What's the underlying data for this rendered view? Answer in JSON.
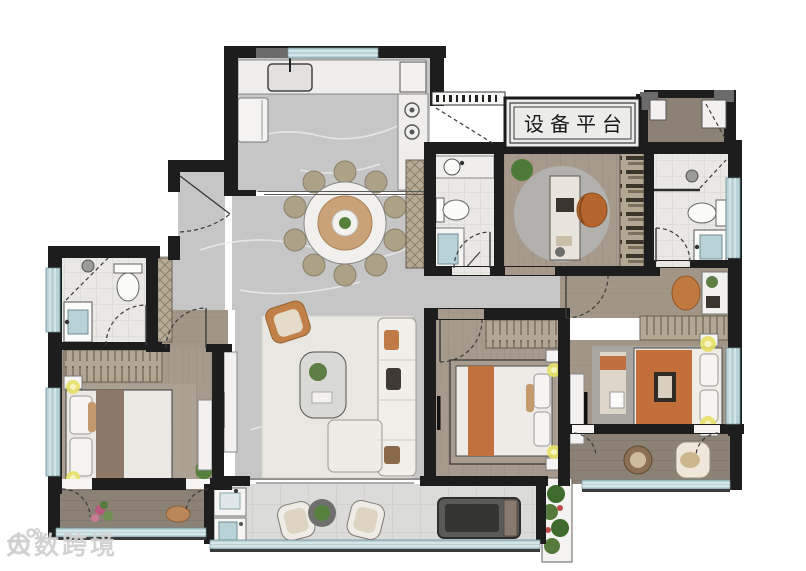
{
  "equipment_platform": {
    "label": "设备平台"
  },
  "watermark": {
    "text": "大数跨境"
  },
  "palette": {
    "wall": "#1d1d1d",
    "marble_floor": "#c6c6c6",
    "wood_floor": "#a79a8c",
    "bath_tile": "#eae8e4",
    "balcony_tile": "#dbdbd9",
    "balcony_wood": "#8b8175",
    "window_glass": "#aac7cc",
    "accent_orange": "#c1713d",
    "bed_blanket_brown": "#8d7766",
    "lamp_yellow": "#e8e168",
    "plant_green": "#55803e",
    "closet_tan": "#b6aa97",
    "rug_light": "#e9e7e2"
  }
}
